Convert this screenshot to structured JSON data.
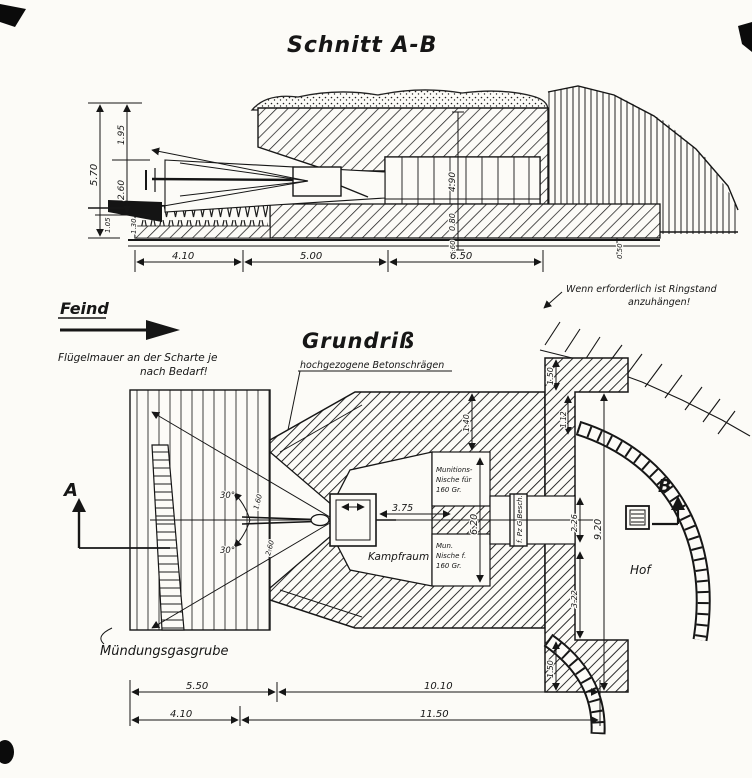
{
  "section": {
    "title": "Schnitt A-B",
    "dims": {
      "total_height": "5.70",
      "roof": "1.95",
      "mid": "2.60",
      "small_a": "1.05",
      "small_b": "1.30",
      "interior": "4.90",
      "floor": "0.80",
      "base": "0.60",
      "base_right": "0.50",
      "front": "4.10",
      "room": "5.00",
      "rear": "6.50"
    }
  },
  "plan": {
    "title": "Grundriß",
    "enemy": "Feind",
    "note_wing_1": "Flügelmauer an der Scharte je",
    "note_wing_2": "nach Bedarf!",
    "note_slope": "hochgezogene Betonschrägen",
    "note_ring_1": "Wenn erforderlich ist Ringstand",
    "note_ring_2": "anzuhängen!",
    "label_gas_pit": "Mündungsgasgrube",
    "label_fighting_room": "Kampfraum",
    "niche_top_1": "Munitions-",
    "niche_top_2": "Nische für",
    "niche_top_3": "160 Gr.",
    "niche_bottom_1": "Mun.",
    "niche_bottom_2": "Nische f.",
    "niche_bottom_3": "160 Gr.",
    "door": "f. Pz G Besch.",
    "courtyard": "Hof",
    "marker_a": "A",
    "marker_b": "B",
    "angle_upper": "30°",
    "angle_lower": "30°",
    "dims": {
      "gun_to_wall": "3.75",
      "niche_wall": "6.20",
      "pier": "9.20",
      "rear_top": "2.26",
      "rear_bottom": "3.22",
      "flange_top": "1.50",
      "gap_top": "1.12",
      "flange_bottom": "1.50",
      "wall_thick": "1.40",
      "throat": "1.60",
      "mouth": "2.60",
      "front_width": "5.50",
      "body_width": "10.10",
      "apron": "4.10",
      "total_width": "11.50"
    }
  }
}
